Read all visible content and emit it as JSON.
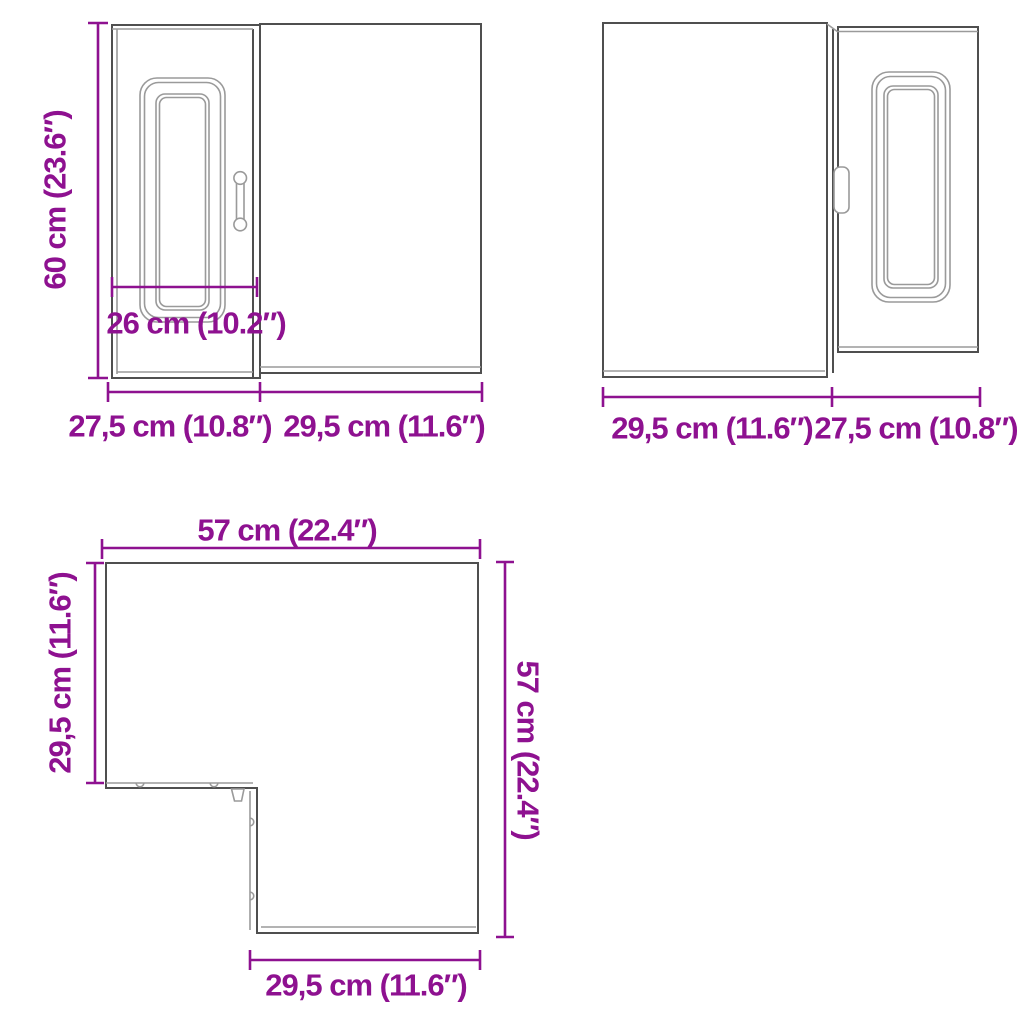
{
  "title": "Corner wall cabinet dimension diagram",
  "colors": {
    "dimension_text": "#8E1190",
    "outline_dark": "#4F4F4F",
    "outline_light": "#9A9A9A",
    "background": "#FFFFFF"
  },
  "front_view_a": {
    "height": "60 cm (23.6″)",
    "door_width": "26 cm (10.2″)",
    "width_left": "27,5 cm (10.8″)",
    "width_right": "29,5 cm (11.6″)"
  },
  "front_view_b": {
    "width_left": "29,5 cm (11.6″)",
    "width_right": "27,5 cm (10.8″)"
  },
  "top_view": {
    "width_top": "57 cm (22.4″)",
    "depth_left": "29,5 cm (11.6″)",
    "height_right": "57 cm (22.4″)",
    "width_bottom": "29,5 cm (11.6″)"
  }
}
